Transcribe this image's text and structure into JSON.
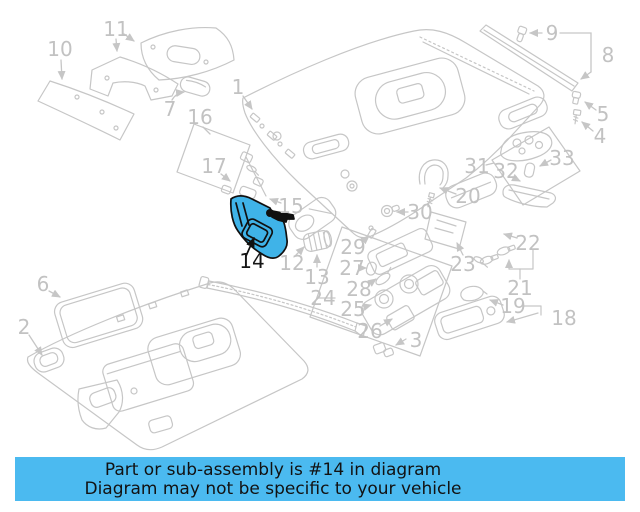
{
  "diagram": {
    "description": "Exploded parts diagram of vehicle roof headliner and trim",
    "highlighted_part": "14",
    "line_color": "#c6c6c6",
    "label_color": "#c2c2c2",
    "highlight_fill": "#3fb3e8",
    "highlight_outline": "#101010",
    "labels": [
      {
        "num": "1",
        "x": 238,
        "y": 87,
        "highlighted": false
      },
      {
        "num": "2",
        "x": 24,
        "y": 327,
        "highlighted": false
      },
      {
        "num": "3",
        "x": 416,
        "y": 340,
        "highlighted": false
      },
      {
        "num": "4",
        "x": 600,
        "y": 136,
        "highlighted": false
      },
      {
        "num": "5",
        "x": 603,
        "y": 114,
        "highlighted": false
      },
      {
        "num": "6",
        "x": 43,
        "y": 284,
        "highlighted": false
      },
      {
        "num": "7",
        "x": 170,
        "y": 109,
        "highlighted": false
      },
      {
        "num": "8",
        "x": 608,
        "y": 55,
        "highlighted": false
      },
      {
        "num": "9",
        "x": 552,
        "y": 33,
        "highlighted": false
      },
      {
        "num": "10",
        "x": 60,
        "y": 49,
        "highlighted": false
      },
      {
        "num": "11",
        "x": 116,
        "y": 29,
        "highlighted": false
      },
      {
        "num": "12",
        "x": 292,
        "y": 263,
        "highlighted": false
      },
      {
        "num": "13",
        "x": 317,
        "y": 277,
        "highlighted": false
      },
      {
        "num": "14",
        "x": 252,
        "y": 261,
        "highlighted": true
      },
      {
        "num": "15",
        "x": 291,
        "y": 206,
        "highlighted": false
      },
      {
        "num": "16",
        "x": 200,
        "y": 117,
        "highlighted": false
      },
      {
        "num": "17",
        "x": 214,
        "y": 166,
        "highlighted": false
      },
      {
        "num": "18",
        "x": 564,
        "y": 318,
        "highlighted": false
      },
      {
        "num": "19",
        "x": 513,
        "y": 306,
        "highlighted": false
      },
      {
        "num": "20",
        "x": 468,
        "y": 196,
        "highlighted": false
      },
      {
        "num": "21",
        "x": 520,
        "y": 288,
        "highlighted": false
      },
      {
        "num": "22",
        "x": 528,
        "y": 243,
        "highlighted": false
      },
      {
        "num": "23",
        "x": 463,
        "y": 264,
        "highlighted": false
      },
      {
        "num": "24",
        "x": 323,
        "y": 298,
        "highlighted": false
      },
      {
        "num": "25",
        "x": 353,
        "y": 309,
        "highlighted": false
      },
      {
        "num": "26",
        "x": 370,
        "y": 331,
        "highlighted": false
      },
      {
        "num": "27",
        "x": 352,
        "y": 268,
        "highlighted": false
      },
      {
        "num": "28",
        "x": 359,
        "y": 289,
        "highlighted": false
      },
      {
        "num": "29",
        "x": 353,
        "y": 247,
        "highlighted": false
      },
      {
        "num": "30",
        "x": 420,
        "y": 212,
        "highlighted": false
      },
      {
        "num": "31",
        "x": 477,
        "y": 166,
        "highlighted": false
      },
      {
        "num": "32",
        "x": 506,
        "y": 171,
        "highlighted": false
      },
      {
        "num": "33",
        "x": 562,
        "y": 158,
        "highlighted": false
      }
    ]
  },
  "banner": {
    "bg": "#4bbaf0",
    "text_color": "#121212",
    "line1": "Part or sub-assembly is #14 in diagram",
    "line2": "Diagram may not be specific to your vehicle"
  }
}
